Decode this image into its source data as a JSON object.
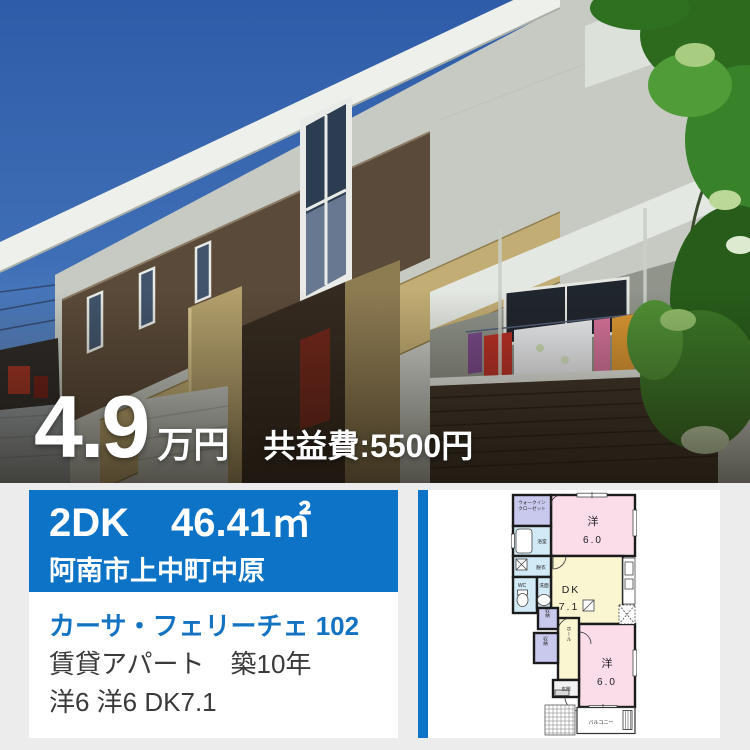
{
  "colors": {
    "page_bg": "#ececec",
    "accent_blue": "#0d73c6",
    "property_name_blue": "#1373c2",
    "body_text": "#3a3a3a",
    "floorplan_pink": "#fadde8",
    "floorplan_yellow": "#faf6d2",
    "floorplan_lavender": "#c9c9ee",
    "floorplan_light_blue": "#d2eaf6",
    "floorplan_wall": "#1b1b1b"
  },
  "photo": {
    "price_value": "4.9",
    "price_unit": "万円",
    "fee_label": "共益費:5500円"
  },
  "summary": {
    "layout": "2DK",
    "area": "46.41㎡",
    "address": "阿南市上中町中原",
    "property_name": "カーサ・フェリーチェ 102",
    "type_and_age": "賃貸アパート　築10年",
    "room_breakdown": "洋6 洋6 DK7.1"
  },
  "floorplan": {
    "walk_in_closet_line1": "ウォークイン",
    "walk_in_closet_line2": "クローゼット",
    "bath": "浴室",
    "dressing_room": "脱衣",
    "toilet": "WC",
    "washstand": "洗面",
    "western_room_1_label": "洋",
    "western_room_1_size": "6.0",
    "dk_label": "DK",
    "dk_size": "7.1",
    "storage_1": "収納",
    "storage_2": "収納",
    "hall": "ホール",
    "entrance": "玄関",
    "western_room_2_label": "洋",
    "western_room_2_size": "6.0",
    "balcony": "バルコニー"
  }
}
